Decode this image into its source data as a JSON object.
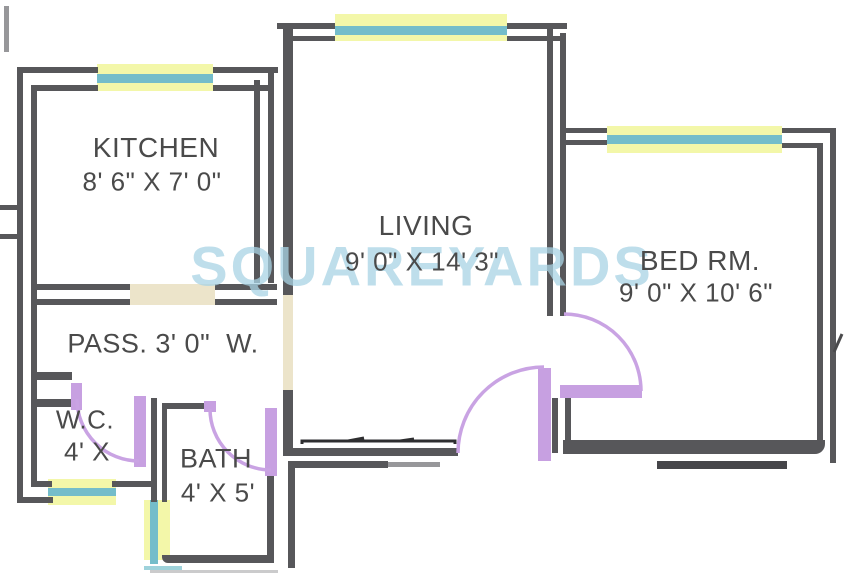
{
  "watermark": {
    "text": "SQUAREYARDS",
    "color": "#a8d3e4"
  },
  "rooms": {
    "kitchen": {
      "name": "KITCHEN",
      "dims": "8' 6\" X 7' 0\""
    },
    "living": {
      "name": "LIVING",
      "dims": "9' 0\" X 14' 3\""
    },
    "bedroom": {
      "name": "BED RM.",
      "dims": "9' 0\" X 10' 6\""
    },
    "passage": {
      "name": "PASS. 3' 0\"  W."
    },
    "wc": {
      "name": "W.C.",
      "dims": "4' X"
    },
    "bath": {
      "name": "BATH",
      "dims": "4' X 5'"
    }
  },
  "legend_colors": {
    "wall": "#57575a",
    "window_glass": "#74bdca",
    "window_frame": "#f3f7a9",
    "door_swing": "#c7a0e1",
    "wall_opening": "#ece4ca",
    "label_text": "#4a4a4a"
  }
}
